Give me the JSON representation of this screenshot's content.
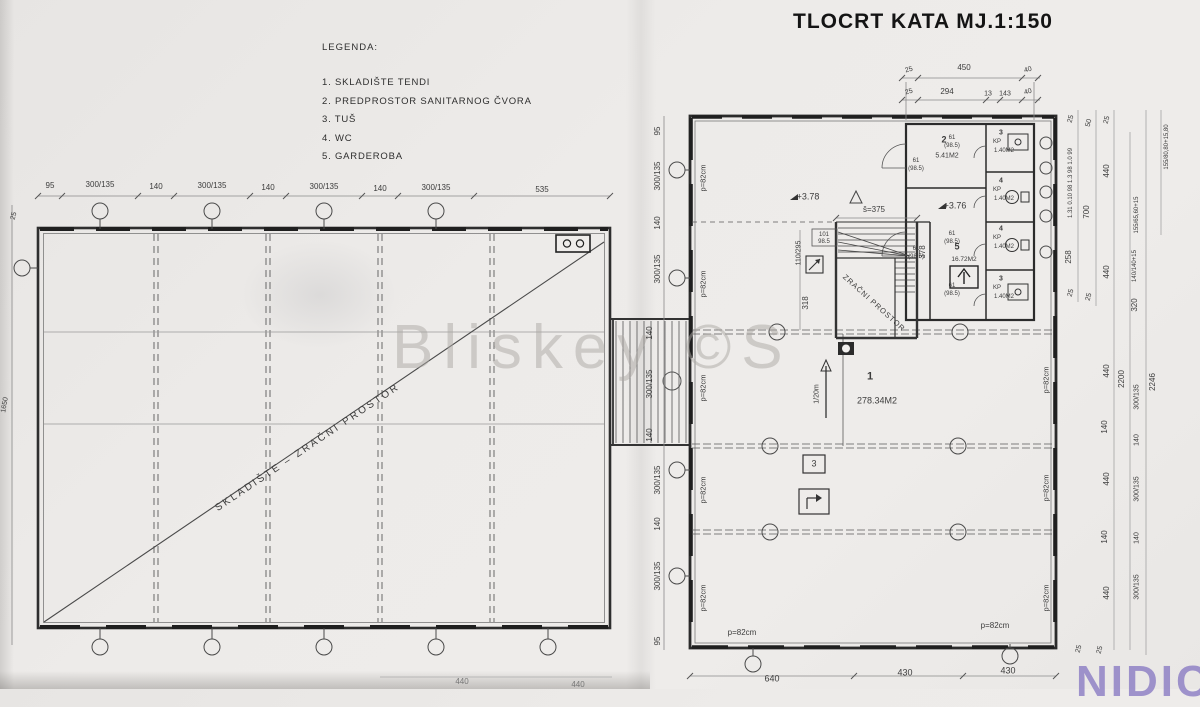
{
  "title": "TLOCRT KATA  MJ.1:150",
  "legend": {
    "heading": "LEGENDA:",
    "items": [
      "1. SKLADIŠTE TENDI",
      "2. PREDPROSTOR SANITARNOG ČVORA",
      "3. TUŠ",
      "4. WC",
      "5. GARDEROBA"
    ]
  },
  "watermark": "Bliskey ©S",
  "corner_logo": "NIDIC",
  "labels": [
    {
      "t": "95",
      "x": 50,
      "y": 186
    },
    {
      "t": "300/135",
      "x": 100,
      "y": 185
    },
    {
      "t": "140",
      "x": 156,
      "y": 187
    },
    {
      "t": "300/135",
      "x": 212,
      "y": 186
    },
    {
      "t": "140",
      "x": 268,
      "y": 188
    },
    {
      "t": "300/135",
      "x": 324,
      "y": 187
    },
    {
      "t": "140",
      "x": 380,
      "y": 189
    },
    {
      "t": "300/135",
      "x": 436,
      "y": 188
    },
    {
      "t": "535",
      "x": 542,
      "y": 190
    },
    {
      "t": "25",
      "x": 14,
      "y": 216,
      "r": -75,
      "s": 7
    },
    {
      "t": "1650",
      "x": 5,
      "y": 405,
      "r": -80,
      "s": 7
    },
    {
      "t": "440",
      "x": 462,
      "y": 682,
      "c": "#777"
    },
    {
      "t": "440",
      "x": 578,
      "y": 685,
      "c": "#777"
    },
    {
      "t": "SKLADIŠTE – ZRAČNI PROSTOR",
      "x": 308,
      "y": 448,
      "r": -34,
      "s": 10,
      "ls": 2.5,
      "n": "left-plan-diagonal-label"
    },
    {
      "t": "140",
      "x": 650,
      "y": 333,
      "r": -90
    },
    {
      "t": "300/135",
      "x": 650,
      "y": 384,
      "r": -90
    },
    {
      "t": "140",
      "x": 650,
      "y": 435,
      "r": -90
    },
    {
      "t": "95",
      "x": 658,
      "y": 131,
      "r": -90
    },
    {
      "t": "300/135",
      "x": 658,
      "y": 176,
      "r": -90
    },
    {
      "t": "140",
      "x": 658,
      "y": 223,
      "r": -90
    },
    {
      "t": "300/135",
      "x": 658,
      "y": 269,
      "r": -90
    },
    {
      "t": "300/135",
      "x": 658,
      "y": 480,
      "r": -90
    },
    {
      "t": "140",
      "x": 658,
      "y": 524,
      "r": -90
    },
    {
      "t": "300/135",
      "x": 658,
      "y": 576,
      "r": -90
    },
    {
      "t": "95",
      "x": 658,
      "y": 641,
      "r": -90
    },
    {
      "t": "25",
      "x": 909,
      "y": 70,
      "r": -15,
      "s": 7
    },
    {
      "t": "450",
      "x": 964,
      "y": 68
    },
    {
      "t": "40",
      "x": 1028,
      "y": 70,
      "r": -15,
      "s": 7
    },
    {
      "t": "25",
      "x": 909,
      "y": 92,
      "r": -15,
      "s": 7
    },
    {
      "t": "294",
      "x": 947,
      "y": 92
    },
    {
      "t": "13",
      "x": 988,
      "y": 94,
      "s": 7
    },
    {
      "t": "143",
      "x": 1005,
      "y": 94,
      "s": 7
    },
    {
      "t": "40",
      "x": 1028,
      "y": 92,
      "r": -15,
      "s": 7
    },
    {
      "t": "2",
      "x": 944,
      "y": 140,
      "s": 9,
      "w": 700,
      "n": "room-number"
    },
    {
      "t": "5.41M2",
      "x": 947,
      "y": 156,
      "s": 7,
      "n": "room-area"
    },
    {
      "t": "3",
      "x": 1001,
      "y": 133,
      "s": 7,
      "w": 700,
      "n": "room-number"
    },
    {
      "t": "KP",
      "x": 997,
      "y": 142,
      "s": 6
    },
    {
      "t": "1.40M2",
      "x": 1004,
      "y": 151,
      "s": 6,
      "n": "room-area"
    },
    {
      "t": "4",
      "x": 1001,
      "y": 181,
      "s": 7,
      "w": 700,
      "n": "room-number"
    },
    {
      "t": "KP",
      "x": 997,
      "y": 190,
      "s": 6
    },
    {
      "t": "1.40M2",
      "x": 1004,
      "y": 199,
      "s": 6,
      "n": "room-area"
    },
    {
      "t": "4",
      "x": 1001,
      "y": 229,
      "s": 7,
      "w": 700,
      "n": "room-number"
    },
    {
      "t": "KP",
      "x": 997,
      "y": 238,
      "s": 6
    },
    {
      "t": "1.40M2",
      "x": 1004,
      "y": 247,
      "s": 6,
      "n": "room-area"
    },
    {
      "t": "3",
      "x": 1001,
      "y": 279,
      "s": 7,
      "w": 700,
      "n": "room-number"
    },
    {
      "t": "KP",
      "x": 997,
      "y": 288,
      "s": 6
    },
    {
      "t": "1.40M2",
      "x": 1004,
      "y": 297,
      "s": 6,
      "n": "room-area"
    },
    {
      "t": "61",
      "x": 952,
      "y": 138,
      "s": 6
    },
    {
      "t": "(98.5)",
      "x": 952,
      "y": 146,
      "s": 6
    },
    {
      "t": "61",
      "x": 952,
      "y": 234,
      "s": 6
    },
    {
      "t": "(98.5)",
      "x": 952,
      "y": 242,
      "s": 6
    },
    {
      "t": "61",
      "x": 952,
      "y": 286,
      "s": 6
    },
    {
      "t": "(98.5)",
      "x": 952,
      "y": 294,
      "s": 6
    },
    {
      "t": "61",
      "x": 916,
      "y": 161,
      "s": 6
    },
    {
      "t": "(98.5)",
      "x": 916,
      "y": 169,
      "s": 6
    },
    {
      "t": "61",
      "x": 916,
      "y": 249,
      "s": 6
    },
    {
      "t": "(98.5)",
      "x": 916,
      "y": 257,
      "s": 6
    },
    {
      "t": "101",
      "x": 824,
      "y": 235,
      "s": 6
    },
    {
      "t": "98.5",
      "x": 824,
      "y": 242,
      "s": 6
    },
    {
      "t": "+3.78",
      "x": 808,
      "y": 197,
      "s": 9,
      "n": "level-marker"
    },
    {
      "t": "+3.76",
      "x": 955,
      "y": 206,
      "s": 9,
      "n": "level-marker"
    },
    {
      "t": "š=375",
      "x": 874,
      "y": 210,
      "s": 8,
      "n": "stair-dimension"
    },
    {
      "t": "110/295",
      "x": 799,
      "y": 253,
      "r": -90,
      "s": 7
    },
    {
      "t": "318",
      "x": 806,
      "y": 303,
      "r": -90
    },
    {
      "t": "378",
      "x": 923,
      "y": 252,
      "r": -90
    },
    {
      "t": "ZRAČNI PROSTOR",
      "x": 874,
      "y": 303,
      "r": 42,
      "s": 7.5,
      "ls": 1,
      "n": "stairwell-void-label"
    },
    {
      "t": "5",
      "x": 957,
      "y": 247,
      "s": 9,
      "w": 700,
      "n": "room-number"
    },
    {
      "t": "16.72M2",
      "x": 964,
      "y": 260,
      "s": 6.5,
      "n": "room-area"
    },
    {
      "t": "1",
      "x": 870,
      "y": 377,
      "s": 11,
      "w": 700,
      "n": "room-number"
    },
    {
      "t": "278.34M2",
      "x": 877,
      "y": 401,
      "s": 9,
      "n": "room-area"
    },
    {
      "t": "1/20m",
      "x": 817,
      "y": 394,
      "r": -90,
      "s": 7,
      "n": "slope-label"
    },
    {
      "t": "3",
      "x": 814,
      "y": 464,
      "s": 9,
      "n": "room-ref-number"
    },
    {
      "t": "p=82cm",
      "x": 703,
      "y": 178,
      "r": -90,
      "s": 7.5,
      "n": "parapet-label"
    },
    {
      "t": "p=82cm",
      "x": 703,
      "y": 284,
      "r": -90,
      "s": 7.5,
      "n": "parapet-label"
    },
    {
      "t": "p=82cm",
      "x": 703,
      "y": 388,
      "r": -90,
      "s": 7.5,
      "n": "parapet-label"
    },
    {
      "t": "p=82cm",
      "x": 703,
      "y": 490,
      "r": -90,
      "s": 7.5,
      "n": "parapet-label"
    },
    {
      "t": "p=82cm",
      "x": 703,
      "y": 598,
      "r": -90,
      "s": 7.5,
      "n": "parapet-label"
    },
    {
      "t": "p=82cm",
      "x": 1046,
      "y": 380,
      "r": -90,
      "s": 7.5,
      "n": "parapet-label"
    },
    {
      "t": "p=82cm",
      "x": 1046,
      "y": 488,
      "r": -90,
      "s": 7.5,
      "n": "parapet-label"
    },
    {
      "t": "p=82cm",
      "x": 1046,
      "y": 598,
      "r": -90,
      "s": 7.5,
      "n": "parapet-label"
    },
    {
      "t": "p=82cm",
      "x": 742,
      "y": 633,
      "s": 8,
      "n": "parapet-label"
    },
    {
      "t": "p=82cm",
      "x": 995,
      "y": 626,
      "s": 8,
      "n": "parapet-label"
    },
    {
      "t": "640",
      "x": 772,
      "y": 679,
      "s": 9
    },
    {
      "t": "430",
      "x": 905,
      "y": 673,
      "s": 9
    },
    {
      "t": "430",
      "x": 1008,
      "y": 671,
      "s": 9
    },
    {
      "t": "25",
      "x": 1071,
      "y": 119,
      "r": -75,
      "s": 7
    },
    {
      "t": "1.31 0.10 98 1.3 98 1.0 99",
      "x": 1071,
      "y": 183,
      "r": -90,
      "s": 6
    },
    {
      "t": "258",
      "x": 1069,
      "y": 257,
      "r": -90
    },
    {
      "t": "25",
      "x": 1071,
      "y": 293,
      "r": -75,
      "s": 7
    },
    {
      "t": "50",
      "x": 1089,
      "y": 123,
      "r": -75,
      "s": 7
    },
    {
      "t": "700",
      "x": 1087,
      "y": 212,
      "r": -90
    },
    {
      "t": "25",
      "x": 1089,
      "y": 297,
      "r": -75,
      "s": 7
    },
    {
      "t": "25",
      "x": 1107,
      "y": 120,
      "r": -75,
      "s": 7
    },
    {
      "t": "440",
      "x": 1107,
      "y": 171,
      "r": -90
    },
    {
      "t": "440",
      "x": 1107,
      "y": 272,
      "r": -90
    },
    {
      "t": "440",
      "x": 1107,
      "y": 371,
      "r": -90
    },
    {
      "t": "140",
      "x": 1105,
      "y": 427,
      "r": -90
    },
    {
      "t": "440",
      "x": 1107,
      "y": 479,
      "r": -90
    },
    {
      "t": "140",
      "x": 1105,
      "y": 537,
      "r": -90
    },
    {
      "t": "440",
      "x": 1107,
      "y": 593,
      "r": -90
    },
    {
      "t": "2200",
      "x": 1122,
      "y": 379,
      "r": -90
    },
    {
      "t": "155/65,60+15",
      "x": 1137,
      "y": 215,
      "r": -90,
      "s": 6
    },
    {
      "t": "140/140+15",
      "x": 1135,
      "y": 266,
      "r": -90,
      "s": 6
    },
    {
      "t": "320",
      "x": 1135,
      "y": 305,
      "r": -90
    },
    {
      "t": "300/135",
      "x": 1137,
      "y": 397,
      "r": -90,
      "s": 7
    },
    {
      "t": "140",
      "x": 1137,
      "y": 440,
      "r": -90,
      "s": 7
    },
    {
      "t": "300/135",
      "x": 1137,
      "y": 489,
      "r": -90,
      "s": 7
    },
    {
      "t": "140",
      "x": 1137,
      "y": 538,
      "r": -90,
      "s": 7
    },
    {
      "t": "300/135",
      "x": 1137,
      "y": 587,
      "r": -90,
      "s": 7
    },
    {
      "t": "2246",
      "x": 1153,
      "y": 382,
      "r": -90
    },
    {
      "t": "155/80,80+15,80",
      "x": 1167,
      "y": 147,
      "r": -90,
      "s": 6
    },
    {
      "t": "25",
      "x": 1079,
      "y": 649,
      "r": -75,
      "s": 7
    },
    {
      "t": "25",
      "x": 1100,
      "y": 650,
      "r": -75,
      "s": 7
    }
  ]
}
